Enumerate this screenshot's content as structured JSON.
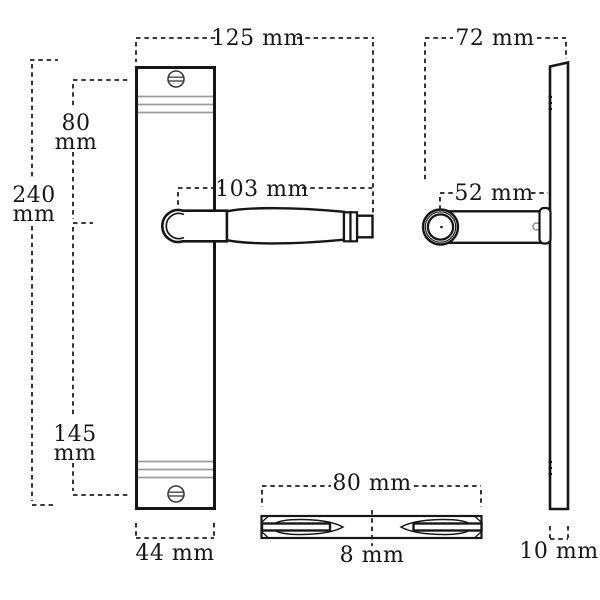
{
  "page": {
    "background": "#ffffff"
  },
  "drawing": {
    "line_color": "#161616",
    "molding_color": "#9b9b9b",
    "dimension_color": "#1f1f1f"
  },
  "labels": {
    "front_total_width": "125 mm",
    "side_projection": "72 mm",
    "handle_length": "103 mm",
    "knob_center_to_plate": "52 mm",
    "top_to_handle": {
      "value": "80",
      "unit": "mm"
    },
    "plate_height": {
      "value": "240",
      "unit": "mm"
    },
    "handle_to_bottom": {
      "value": "145",
      "unit": "mm"
    },
    "plate_width": "44 mm",
    "spindle_view_length": "80 mm",
    "spindle_thickness": "8 mm",
    "plate_thickness": "10 mm"
  }
}
